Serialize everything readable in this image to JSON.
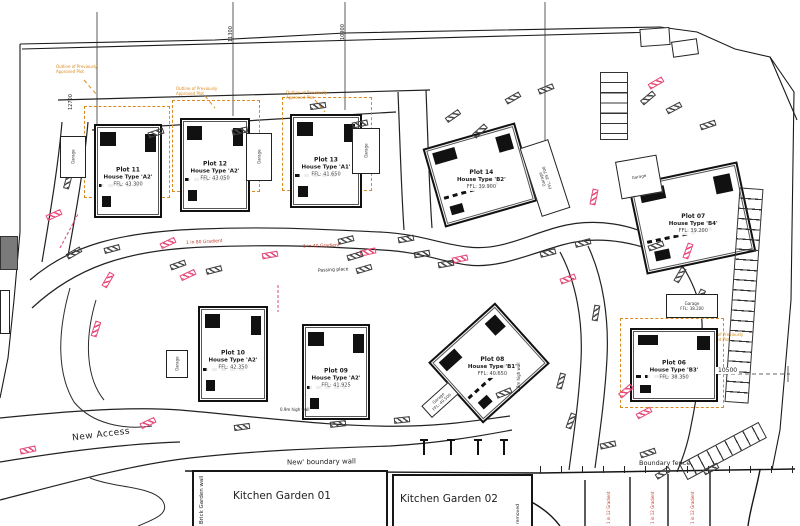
{
  "plots": [
    {
      "plot": "Plot 11",
      "house_type": "House Type 'A2'",
      "ffl": "FFL: 43.300"
    },
    {
      "plot": "Plot 12",
      "house_type": "House Type 'A2'",
      "ffl": "FFL: 43.050"
    },
    {
      "plot": "Plot 13",
      "house_type": "House Type 'A1'",
      "ffl": "FFL: 41.650"
    },
    {
      "plot": "Plot 14",
      "house_type": "House Type 'B2'",
      "ffl": "FFL: 39.900"
    },
    {
      "plot": "Plot 07",
      "house_type": "House Type 'B4'",
      "ffl": "FFL: 39.200"
    },
    {
      "plot": "Plot 10",
      "house_type": "House Type 'A2'",
      "ffl": "FFL: 42.350"
    },
    {
      "plot": "Plot 09",
      "house_type": "House Type 'A2'",
      "ffl": "FFL: 41.925"
    },
    {
      "plot": "Plot 08",
      "house_type": "House Type 'B1'",
      "ffl": "FFL: 40.650"
    },
    {
      "plot": "Plot 06",
      "house_type": "House Type 'B3'",
      "ffl": "FFL: 38.350"
    }
  ],
  "garages": [
    {
      "x": 60,
      "y": 136,
      "w": 26,
      "h": 42,
      "rot": 0,
      "label": "Garage",
      "ffl": "",
      "trot": -90
    },
    {
      "x": 246,
      "y": 133,
      "w": 26,
      "h": 48,
      "rot": 0,
      "label": "Garage",
      "ffl": "",
      "trot": -90
    },
    {
      "x": 352,
      "y": 128,
      "w": 28,
      "h": 46,
      "rot": 0,
      "label": "Garage",
      "ffl": "",
      "trot": -90
    },
    {
      "x": 530,
      "y": 142,
      "w": 30,
      "h": 72,
      "rot": -18,
      "label": "Garage",
      "ffl": "FFL: 39.700",
      "trot": -90
    },
    {
      "x": 666,
      "y": 294,
      "w": 52,
      "h": 24,
      "rot": 0,
      "label": "Garage",
      "ffl": "FFL: 38.200",
      "trot": 0
    },
    {
      "x": 422,
      "y": 392,
      "w": 36,
      "h": 16,
      "rot": -42,
      "label": "Garage",
      "ffl": "FFL: 40.500",
      "trot": 0
    },
    {
      "x": 166,
      "y": 350,
      "w": 22,
      "h": 28,
      "rot": 0,
      "label": "Garage",
      "ffl": "",
      "trot": -90
    },
    {
      "x": 618,
      "y": 158,
      "w": 42,
      "h": 38,
      "rot": -10,
      "label": "Garage",
      "ffl": "",
      "trot": 0
    },
    {
      "x": 640,
      "y": 28,
      "w": 30,
      "h": 18,
      "rot": -4,
      "label": "",
      "ffl": "",
      "trot": 0
    },
    {
      "x": 672,
      "y": 40,
      "w": 26,
      "h": 16,
      "rot": -8,
      "label": "",
      "ffl": "",
      "trot": 0
    }
  ],
  "annotations": {
    "new_access": "New Access",
    "boundary_wall": "New' boundary wall",
    "kitchen_garden_01": "Kitchen Garden 01",
    "kitchen_garden_02": "Kitchen Garden 02",
    "boundary_fence": "Boundary fence",
    "brick_garden_wall": "Brick Garden wall",
    "removed": "removed",
    "passing_place": "Passing place",
    "gradient_left": "1 in 80 Gradient",
    "gradient_right": "1 in 40 Gradient",
    "gradient_vertical": "1 in 12 Gradient",
    "wall_09": "0.9m high wall",
    "wall_18": "1.8m high wall",
    "outline_note_line1": "Outline of Previously",
    "outline_note_line2": "Approved Plot"
  },
  "dimensions": {
    "dim_plot11": "12700",
    "dim_plot12": "11300",
    "dim_plot13": "10900",
    "dim_plot06": "10500"
  },
  "markers": {
    "pink": [
      [
        46,
        212,
        -24
      ],
      [
        160,
        240,
        -25
      ],
      [
        180,
        272,
        -25
      ],
      [
        100,
        277,
        -60
      ],
      [
        88,
        326,
        -72
      ],
      [
        140,
        420,
        -25
      ],
      [
        20,
        447,
        -12
      ],
      [
        262,
        252,
        -10
      ],
      [
        360,
        249,
        -12
      ],
      [
        452,
        256,
        -12
      ],
      [
        560,
        276,
        -20
      ],
      [
        586,
        194,
        -78
      ],
      [
        648,
        80,
        -30
      ],
      [
        680,
        248,
        -70
      ],
      [
        618,
        388,
        -40
      ],
      [
        636,
        410,
        -28
      ]
    ],
    "gray": [
      [
        60,
        178,
        -75
      ],
      [
        66,
        250,
        -30
      ],
      [
        104,
        246,
        -15
      ],
      [
        148,
        130,
        -18
      ],
      [
        232,
        128,
        -12
      ],
      [
        352,
        121,
        -12
      ],
      [
        310,
        103,
        -8
      ],
      [
        445,
        113,
        -35
      ],
      [
        472,
        128,
        -42
      ],
      [
        505,
        95,
        -30
      ],
      [
        538,
        86,
        -22
      ],
      [
        640,
        95,
        -40
      ],
      [
        666,
        105,
        -28
      ],
      [
        700,
        122,
        -18
      ],
      [
        170,
        262,
        -20
      ],
      [
        206,
        267,
        -14
      ],
      [
        338,
        237,
        -14
      ],
      [
        347,
        253,
        -16
      ],
      [
        356,
        266,
        -16
      ],
      [
        398,
        236,
        -10
      ],
      [
        414,
        251,
        -10
      ],
      [
        438,
        261,
        -10
      ],
      [
        540,
        250,
        -14
      ],
      [
        575,
        240,
        -14
      ],
      [
        648,
        243,
        -20
      ],
      [
        672,
        272,
        -60
      ],
      [
        692,
        294,
        -65
      ],
      [
        234,
        424,
        -8
      ],
      [
        330,
        421,
        -6
      ],
      [
        394,
        417,
        -6
      ],
      [
        563,
        418,
        -70
      ],
      [
        553,
        378,
        -75
      ],
      [
        600,
        442,
        -12
      ],
      [
        640,
        450,
        -18
      ],
      [
        655,
        470,
        -32
      ],
      [
        703,
        466,
        -28
      ],
      [
        496,
        390,
        -22
      ],
      [
        588,
        310,
        -80
      ]
    ]
  },
  "colors": {
    "approved_outline": "#d98b1f",
    "marker_pink": "#e64a78",
    "gradient_text": "#c0392b",
    "linework": "#1a1a1a",
    "existing_building": "#7a7a7a"
  }
}
